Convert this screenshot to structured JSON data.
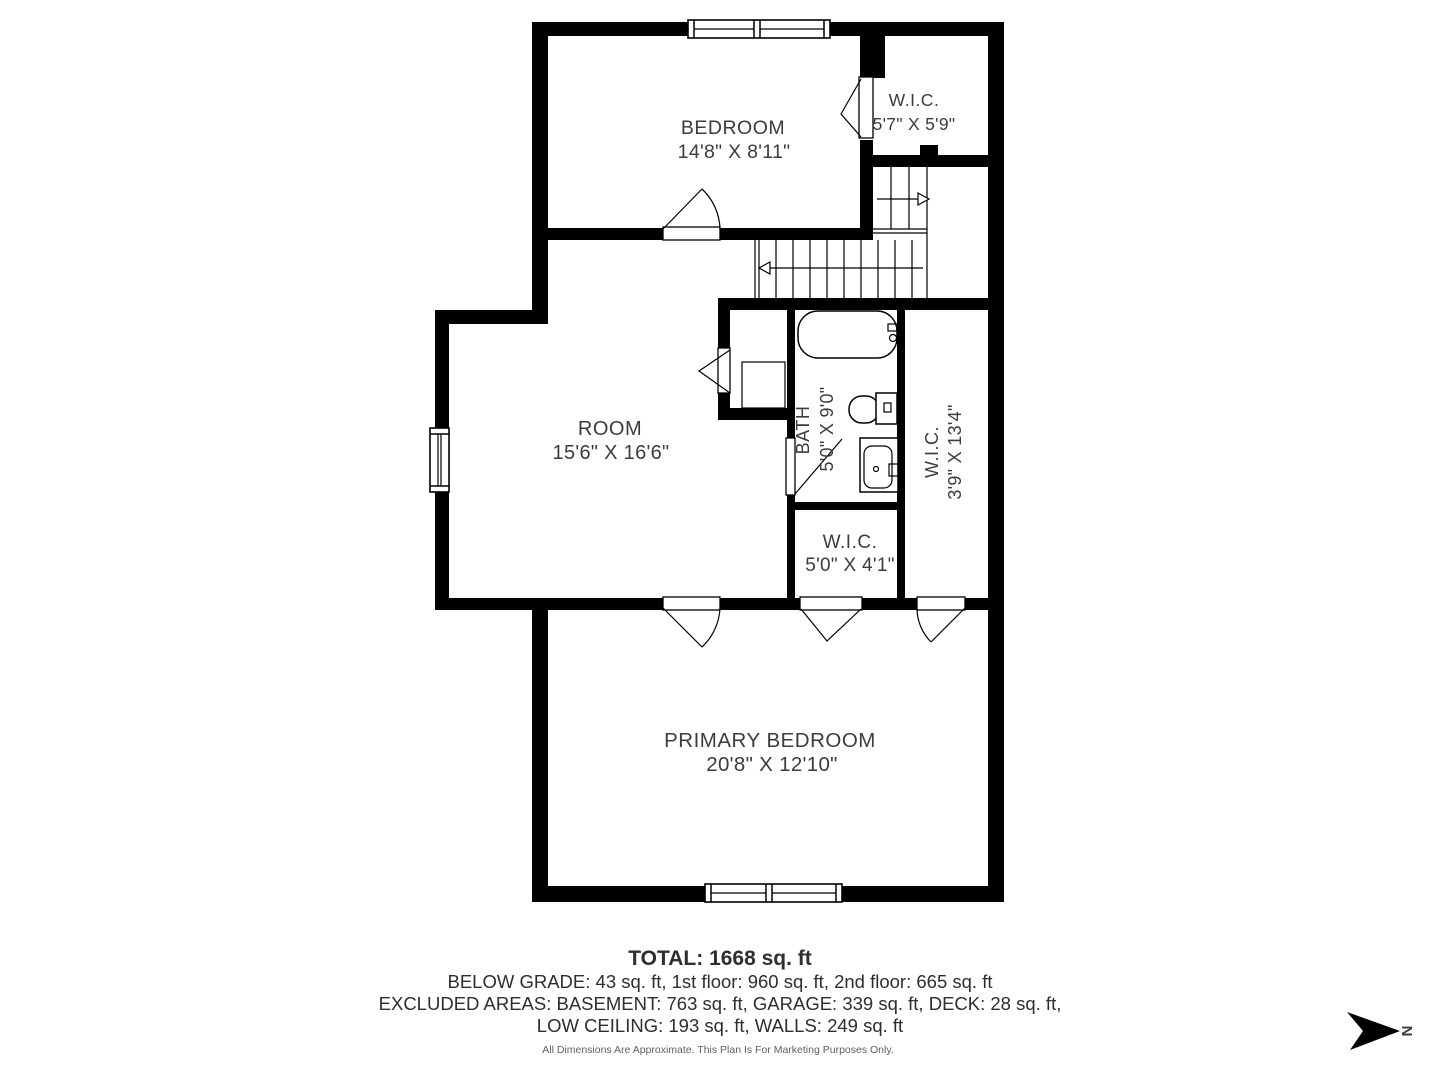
{
  "rooms": {
    "bedroom": {
      "name": "BEDROOM",
      "dims": "14'8\" X 8'11\""
    },
    "wic_top": {
      "name": "W.I.C.",
      "dims": "5'7\" X 5'9\""
    },
    "room": {
      "name": "ROOM",
      "dims": "15'6\" X 16'6\""
    },
    "bath": {
      "name": "BATH",
      "dims": "5'0\" X 9'0\""
    },
    "wic_right": {
      "name": "W.I.C.",
      "dims": "3'9\" X 13'4\""
    },
    "wic_small": {
      "name": "W.I.C.",
      "dims": "5'0\" X 4'1\""
    },
    "primary": {
      "name": "PRIMARY BEDROOM",
      "dims": "20'8\" X 12'10\""
    }
  },
  "summary": {
    "total": "TOTAL: 1668 sq. ft",
    "below_grade_line": "BELOW GRADE: 43 sq. ft, 1st floor: 960 sq. ft, 2nd floor: 665 sq. ft",
    "excluded_line": "EXCLUDED AREAS: BASEMENT: 763 sq. ft, GARAGE: 339 sq. ft, DECK: 28 sq. ft,",
    "low_ceiling_line": "LOW CEILING: 193 sq. ft, WALLS: 249 sq. ft",
    "disclaimer": "All Dimensions Are Approximate. This Plan Is For Marketing Purposes Only."
  },
  "compass": {
    "north_label": "N"
  },
  "colors": {
    "wall": "#000000",
    "text": "#3c3c3c",
    "background": "#ffffff"
  }
}
